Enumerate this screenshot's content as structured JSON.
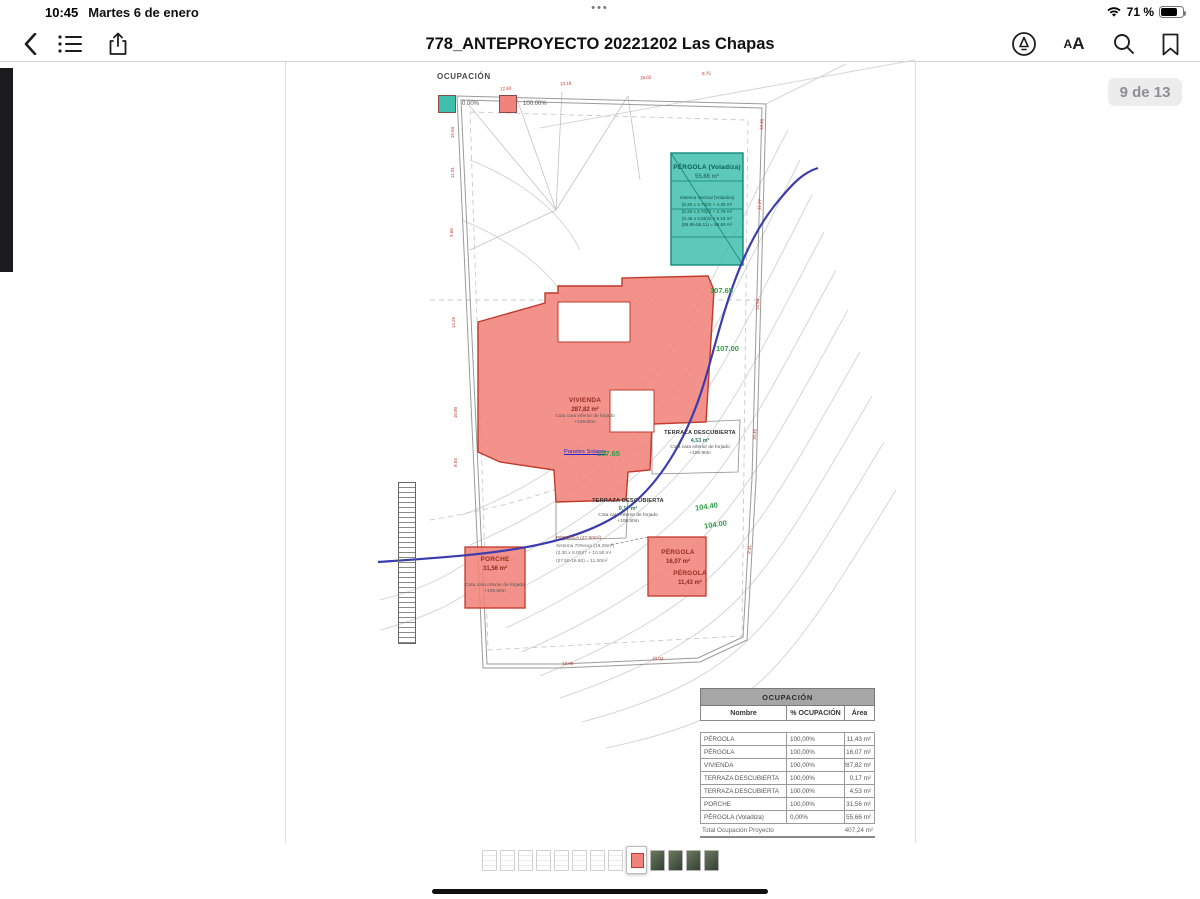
{
  "status_bar": {
    "time": "10:45",
    "date": "Martes 6 de enero",
    "battery": "71 %",
    "multitask_dots": "•••"
  },
  "toolbar": {
    "title": "778_ANTEPROYECTO 20221202 Las Chapas",
    "aa_small": "A",
    "aa_large": "A"
  },
  "page_badge": "9 de 13",
  "colors": {
    "occupied_fill": "#f0837b",
    "occupied_border": "#c0392b",
    "free_fill": "#3fbfae",
    "free_border": "#14897b",
    "contour_label_green": "#2f9e49",
    "blue_line": "#3c3cae",
    "red_mark": "#c0392b"
  },
  "legend": {
    "title": "OCUPACIÓN",
    "items": [
      {
        "label": "0.00%",
        "color": "#3fbfae"
      },
      {
        "label": "100.00%",
        "color": "#f0837b"
      }
    ]
  },
  "plan": {
    "pergola_voladiza": {
      "name": "PÉRGOLA (Voladiza)",
      "area": "55.66 m²",
      "lines": [
        "Sistema Vertical (Voladiza)",
        "(8.30 x 4.70)/2 + 4.25 m²",
        "(8.30 x 4.70)/2 + 2.78 m²",
        "(0.45 x 0.55)/2 x 8.18 m²",
        "(55.95-56.11) = 55.66 m²"
      ]
    },
    "vivienda": {
      "name": "VIVIENDA",
      "area": "287,82 m²",
      "note1": "Cota cara inferior de forjado",
      "note2": "+109.50m",
      "link": "Paneles Solares"
    },
    "terraza_right": {
      "name": "TERRAZA DESCUBIERTA",
      "area": "4,53 m²",
      "note1": "Cota cara inferior de forjado",
      "note2": "+106.90m"
    },
    "terraza_lower": {
      "name": "TERRAZA DESCUBIERTA",
      "area": "0,17 m²",
      "note1": "Cota cara inferior de forjado",
      "note2": "+108.50m"
    },
    "porche": {
      "name": "PORCHE",
      "area": "31,56 m²",
      "note1": "Cota cara inferior de forjado",
      "note2": "+109.50m"
    },
    "pergola_formulas": [
      "PÉRGOLA (27.50m²)",
      "Sistema 70%sup (19,25m²)",
      "(2.30 x 5.00)/7 + 10.50 m²",
      "(27.50-16.50) = 11.00m²"
    ],
    "pergola_sq1": {
      "name": "PÉRGOLA",
      "area": "16,07 m²"
    },
    "pergola_sq2": {
      "name": "PÉRGOLA",
      "area": "11,43 m²"
    },
    "contour_labels": [
      {
        "text": "107.65",
        "x": 710,
        "y": 286,
        "rot": 0
      },
      {
        "text": "107.00",
        "x": 716,
        "y": 344,
        "rot": 0
      },
      {
        "text": "107.65",
        "x": 597,
        "y": 449,
        "rot": 0
      },
      {
        "text": "104.40",
        "x": 695,
        "y": 502,
        "rot": -8
      },
      {
        "text": "104.00",
        "x": 704,
        "y": 520,
        "rot": -8
      }
    ],
    "boundary_marks": [
      {
        "text": "15.04",
        "x": 447,
        "y": 130,
        "rot": -90
      },
      {
        "text": "11.91",
        "x": 447,
        "y": 170,
        "rot": -90
      },
      {
        "text": "9.66",
        "x": 447,
        "y": 230,
        "rot": -90
      },
      {
        "text": "14.25",
        "x": 448,
        "y": 320,
        "rot": -90
      },
      {
        "text": "10.80",
        "x": 450,
        "y": 410,
        "rot": -90
      },
      {
        "text": "8.04",
        "x": 451,
        "y": 460,
        "rot": -90
      },
      {
        "text": "12.93",
        "x": 500,
        "y": 86,
        "rot": -4
      },
      {
        "text": "10.18",
        "x": 560,
        "y": 81,
        "rot": -4
      },
      {
        "text": "16.02",
        "x": 640,
        "y": 75,
        "rot": -4
      },
      {
        "text": "9.75",
        "x": 702,
        "y": 71,
        "rot": -4
      },
      {
        "text": "13.40",
        "x": 756,
        "y": 122,
        "rot": -85
      },
      {
        "text": "11.27",
        "x": 754,
        "y": 202,
        "rot": -85
      },
      {
        "text": "14.84",
        "x": 752,
        "y": 302,
        "rot": -85
      },
      {
        "text": "10.45",
        "x": 749,
        "y": 432,
        "rot": -85
      },
      {
        "text": "9.31",
        "x": 745,
        "y": 547,
        "rot": -85
      },
      {
        "text": "12.66",
        "x": 562,
        "y": 661,
        "rot": 2
      },
      {
        "text": "10.02",
        "x": 652,
        "y": 656,
        "rot": 2
      }
    ]
  },
  "table": {
    "title": "OCUPACIÓN",
    "columns": [
      "Nombre",
      "% OCUPACIÓN",
      "Área"
    ],
    "rows": [
      [
        "PÉRGOLA",
        "100,00%",
        "11,43 m²"
      ],
      [
        "PÉRGOLA",
        "100,00%",
        "16,07 m²"
      ],
      [
        "VIVIENDA",
        "100,00%",
        "287,82 m²"
      ],
      [
        "TERRAZA DESCUBIERTA",
        "100,00%",
        "0,17 m²"
      ],
      [
        "TERRAZA DESCUBIERTA",
        "100,00%",
        "4,53 m²"
      ],
      [
        "PORCHE",
        "100,00%",
        "31,56 m²"
      ],
      [
        "PÉRGOLA (Voladiza)",
        "0,00%",
        "55,66 m²"
      ]
    ],
    "total_label": "Total Ocupación Proyecto",
    "total_value": "407,24 m²"
  },
  "thumbnails": {
    "types": [
      "page",
      "page",
      "page",
      "page",
      "page",
      "page",
      "page",
      "page",
      "current",
      "photo",
      "photo",
      "photo",
      "photo"
    ]
  }
}
